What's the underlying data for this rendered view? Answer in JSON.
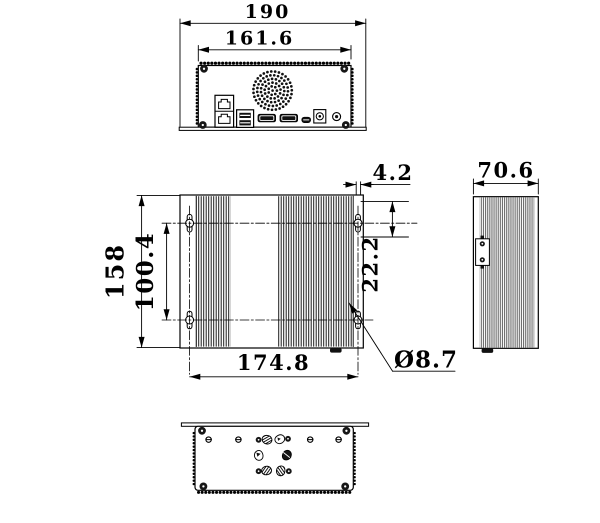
{
  "dims": {
    "rear_overall_width": "190",
    "rear_body_width": "161.6",
    "top_depth": "158",
    "mount_spacing_vertical": "100.4",
    "mount_spacing_horizontal": "174.8",
    "slot_width": "4.2",
    "mount_hole_inset": "22.2",
    "mount_hole_diameter": "Ø8.7",
    "side_width": "70.6"
  },
  "colors": {
    "ink": "#000000",
    "background": "#ffffff",
    "fin_dark": "#1c1c1c",
    "fin_gray": "#4a4a4a"
  }
}
